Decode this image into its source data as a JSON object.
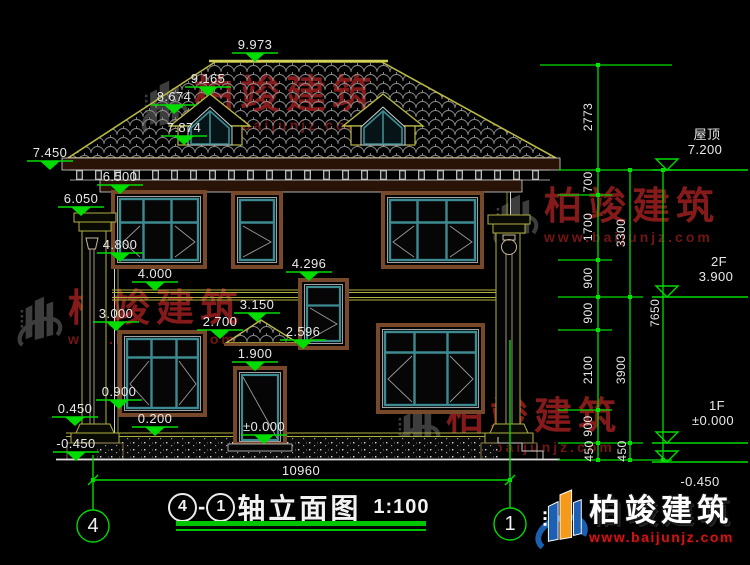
{
  "drawing": {
    "title": {
      "axis_from": "4",
      "dash": "-",
      "axis_to": "1",
      "name": "轴立面图",
      "scale": "1:100"
    },
    "axis_bubbles": {
      "left": "4",
      "right": "1"
    },
    "dims": {
      "ridge": "9.973",
      "dormer_peak": "9.165",
      "dormer_eave": "8.674",
      "dormer_sill": "7.874",
      "eave": "7.450",
      "cornice": "6.500",
      "pillar_top": "6.050",
      "sill_2f": "4.800",
      "slab_2f": "4.000",
      "stair_win_top": "4.296",
      "win_1f_top": "3.000",
      "canopy_top": "3.150",
      "canopy_eave": "2.700",
      "stair_win_bottom": "2.596",
      "door_top": "1.900",
      "sill_1f": "0.900",
      "pillar_base": "0.450",
      "terrace": "0.200",
      "door_zero": "±0.000",
      "ground": "-0.450",
      "total_width": "10960"
    },
    "chains": {
      "inner": [
        "2773",
        "700",
        "1700",
        "900",
        "900",
        "2100",
        "900",
        "450"
      ],
      "middle": [
        "3300",
        "3900",
        "450"
      ],
      "outer": [
        "7650"
      ]
    },
    "levels": {
      "roof_label": "屋顶",
      "roof_value": "7.200",
      "f2_label": "2F",
      "f2_value": "3.900",
      "f1_label": "1F",
      "f1_value": "±0.000",
      "ground_value": "-0.450"
    }
  },
  "watermark": {
    "brand": "柏竣建筑",
    "url": "www.baijunjz.com"
  },
  "logo": {
    "brand": "柏竣建筑",
    "url": "www.baijunjz.com"
  },
  "colors": {
    "dimension_green": "#00dc00",
    "cad_olive": "#b8b845",
    "frame_teal": "#3d8b91",
    "frame_brown": "#77492a",
    "watermark_red": "#a32020",
    "logo_blue": "#1d5fb3",
    "logo_orange": "#f59a1a"
  }
}
